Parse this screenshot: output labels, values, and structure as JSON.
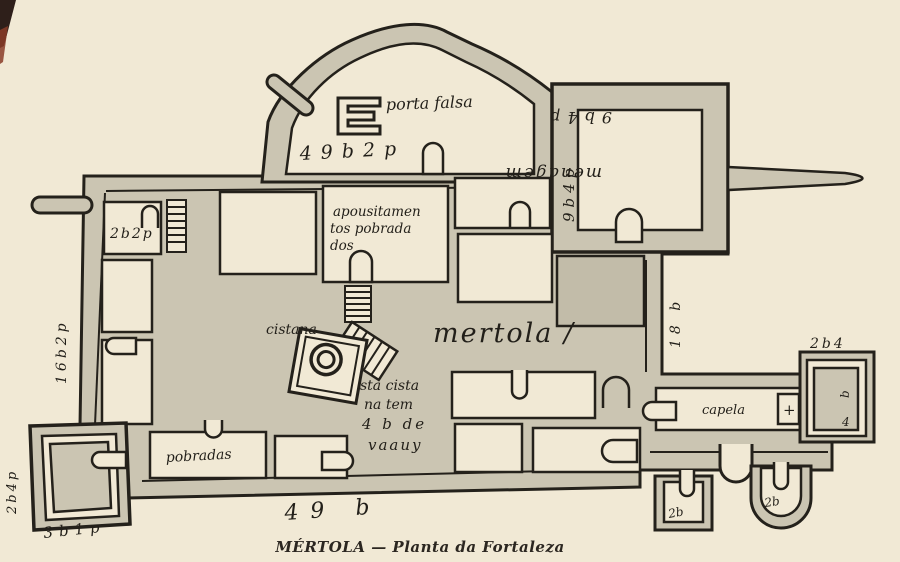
{
  "palette": {
    "paper": "#f1e9d5",
    "wall_fill": "#cbc5b2",
    "wall_fill_dark": "#c2bca9",
    "ink": "#24211b",
    "caption_ink": "#2b2620",
    "stain": "#a9703f"
  },
  "caption": {
    "text": "MÉRTOLA — Planta da Fortaleza"
  },
  "labels": {
    "porta_falsa": "porta falsa",
    "north_measure": "49b2p",
    "keep_name": "menagem",
    "keep_measure_top": "9b4p",
    "keep_measure_side": "9b4p",
    "nw_room_measure": "2b2p",
    "lodgings_1": "apousitamen",
    "lodgings_2": "tos pobrada",
    "lodgings_3": "dos",
    "castle_name": "mertola /",
    "cistern": "cistana",
    "note_1": "sta cista",
    "note_2": "na tem",
    "note_3": "4 b de",
    "note_4": "vaauy",
    "dwellings": "pobradas",
    "south_measure": "49 b",
    "west_measure": "16b2p",
    "east_measure": "18 b",
    "chapel": "capela",
    "chapel_cross": "+",
    "chapel_tower_measure": "2b4",
    "chapel_tower_inner_b": "b",
    "chapel_tower_inner_4": "4",
    "sw_tower_side": "2b4p",
    "sw_tower_bottom": "3b1p",
    "se_square_tower": "2b",
    "se_round_tower": "2b"
  }
}
